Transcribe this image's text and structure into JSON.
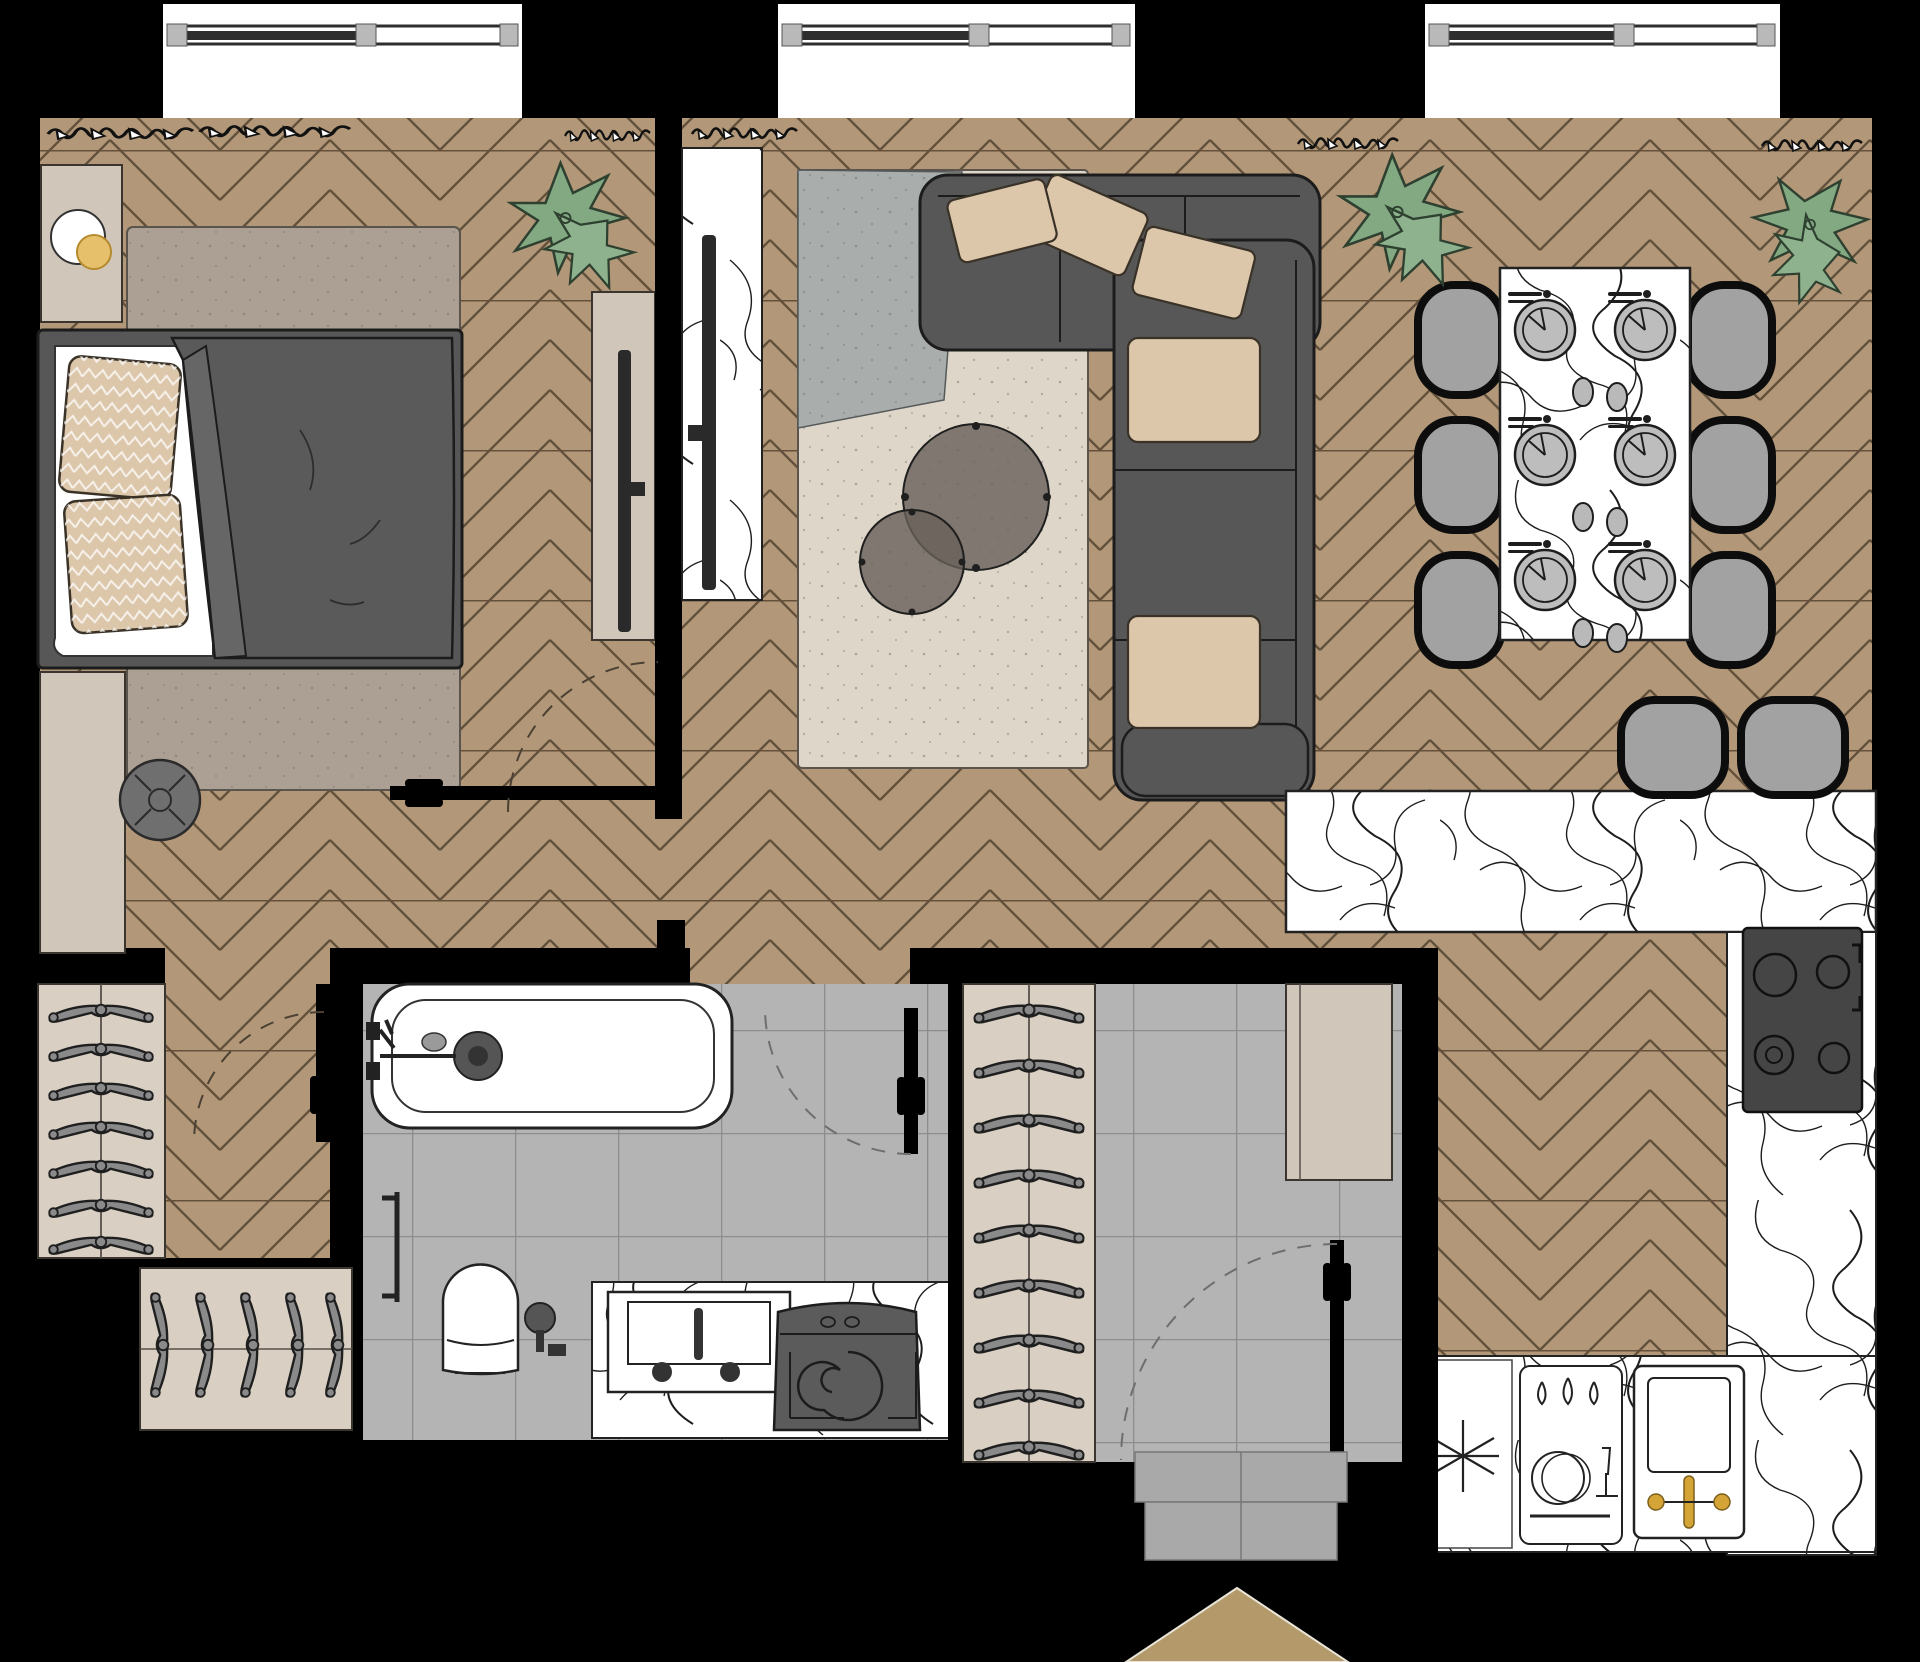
{
  "plan": {
    "type": "apartment-floor-plan-top-view",
    "windows_count": 3,
    "rooms": [
      "bedroom",
      "living-room",
      "dining-area",
      "kitchen",
      "bathroom",
      "entry-hall",
      "walk-in-closet",
      "corridor"
    ],
    "inventory": {
      "bedroom": [
        "nightstand",
        "table-lamp",
        "double-bed",
        "pillow",
        "pillow",
        "duvet",
        "area-rug",
        "pouf",
        "dresser",
        "tv-console",
        "tv"
      ],
      "living": [
        "marble-tv-panel",
        "tv",
        "two-tone-rug",
        "coffee-table-large",
        "coffee-table-small",
        "corner-sofa",
        "sofa-pillows",
        "plant"
      ],
      "dining": [
        "marble-dining-table",
        "place-settings",
        "dining-chairs",
        "plant",
        "plant"
      ],
      "kitchen": [
        "island-counter",
        "bar-stool",
        "bar-stool",
        "cooktop",
        "freezer-symbol",
        "dishwasher-symbol",
        "kitchen-sink",
        "gold-faucet"
      ],
      "bathroom": [
        "bathtub",
        "tub-faucet",
        "drain",
        "towel-rail",
        "toilet",
        "toilet-brush",
        "vanity-sink",
        "washing-machine"
      ],
      "hall": [
        "hanger-closet",
        "hanger-closet-2",
        "entry-closet",
        "hall-cabinet",
        "entry-door",
        "threshold",
        "entry-arrow"
      ]
    },
    "counts": {
      "dining_chairs": 6,
      "place_settings": 6,
      "bar_stools": 2,
      "closet_hangers_left": 7,
      "closet_hangers_bottom": 5,
      "closet_hangers_entry": 9,
      "coffee_tables": 2,
      "plants": 3,
      "doors_with_swing_arcs": 4
    }
  },
  "colors": {
    "bg": "#000000",
    "wood": "#b29878",
    "wood_line": "#64513b",
    "tile": "#b4b4b4",
    "tile_line": "#8d8d8d",
    "window_white": "#ffffff",
    "frame_dark": "#2e2e2e",
    "frame_gray": "#b9b9b9",
    "marble": "#ffffff",
    "vein": "#1d1d1d",
    "rug_bed": "#aca094",
    "rug_gray": "#a9adac",
    "rug_cream": "#ded7c9",
    "beige": "#d0c7ba",
    "closet": "#d9d0c3",
    "sofa": "#575757",
    "duvet": "#5a5a5a",
    "sheet": "#ffffff",
    "pillow": "#dcc7ab",
    "pouf": "#6f6f6f",
    "seat": "#a2a2a2",
    "stove": "#454545",
    "gold": "#d4a437",
    "lamp_gold": "#e6c06b",
    "plant": "#83a983",
    "plant_line": "#2e4030",
    "arrow_tan": "#b49a6b",
    "ink": "#222222",
    "white_fix": "#ffffff"
  }
}
